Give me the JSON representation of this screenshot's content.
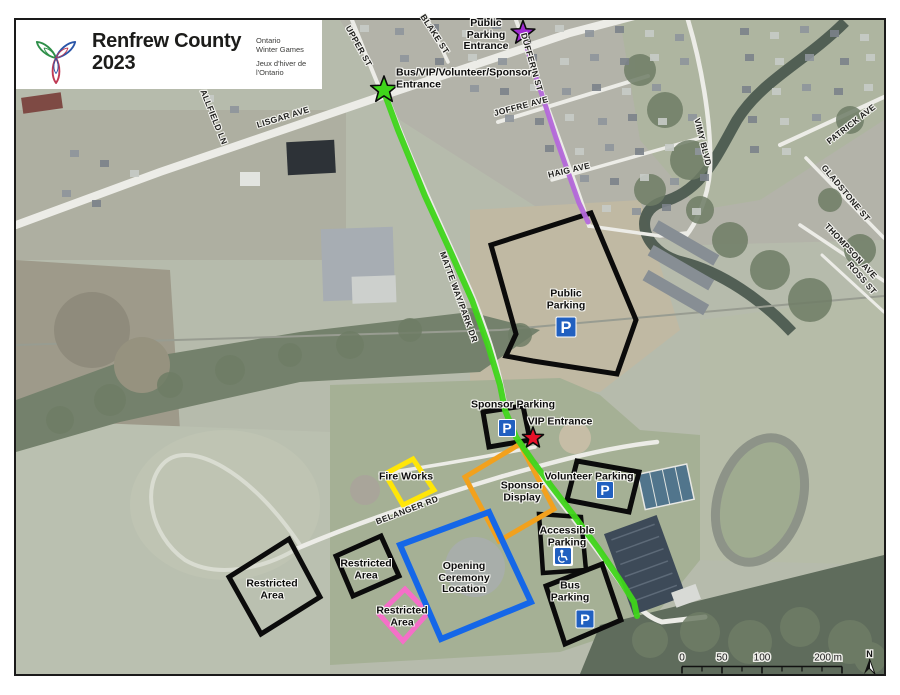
{
  "logo": {
    "title_line1": "Renfrew County",
    "title_line2": "2023",
    "org_en_line1": "Ontario",
    "org_en_line2": "Winter Games",
    "org_fr_line1": "Jeux d'hiver de",
    "org_fr_line2": "l'Ontario"
  },
  "map": {
    "street_labels": [
      {
        "name": "street-label-lisgar-ave",
        "text": "LISGAR AVE",
        "x": 283,
        "y": 117,
        "rot": -17
      },
      {
        "name": "street-label-allfield-ln",
        "text": "ALLFIELD LN",
        "x": 214,
        "y": 117,
        "rot": 68
      },
      {
        "name": "street-label-upper-st",
        "text": "UPPER ST",
        "x": 359,
        "y": 46,
        "rot": 61
      },
      {
        "name": "street-label-blake-st",
        "text": "BLAKE ST",
        "x": 435,
        "y": 34,
        "rot": 57
      },
      {
        "name": "street-label-dufferin-st",
        "text": "DUFFERIN ST",
        "x": 532,
        "y": 62,
        "rot": 74
      },
      {
        "name": "street-label-joffre-ave",
        "text": "JOFFRE AVE",
        "x": 521,
        "y": 106,
        "rot": -15
      },
      {
        "name": "street-label-haig-ave",
        "text": "HAIG AVE",
        "x": 569,
        "y": 170,
        "rot": -13
      },
      {
        "name": "street-label-vimy-blvd",
        "text": "VIMY BLVD",
        "x": 703,
        "y": 142,
        "rot": 76
      },
      {
        "name": "street-label-patrick-ave",
        "text": "PATRICK AVE",
        "x": 851,
        "y": 124,
        "rot": -38
      },
      {
        "name": "street-label-gladstone-st",
        "text": "GLADSTONE ST",
        "x": 846,
        "y": 193,
        "rot": 50
      },
      {
        "name": "street-label-thompson-ave",
        "text": "THOMPSON AVE",
        "x": 851,
        "y": 251,
        "rot": 47
      },
      {
        "name": "street-label-ross-st",
        "text": "ROSS ST",
        "x": 862,
        "y": 278,
        "rot": 49
      },
      {
        "name": "street-label-matte-way-park-dr",
        "text": "MATTE WAY/PARK DR",
        "x": 459,
        "y": 297,
        "rot": 70
      },
      {
        "name": "street-label-belanger-rd",
        "text": "BELANGER RD",
        "x": 407,
        "y": 510,
        "rot": -21
      }
    ],
    "annotations": [
      {
        "name": "public-parking-entrance-label",
        "lines": [
          "Public",
          "Parking",
          "Entrance"
        ],
        "x": 486,
        "y": 35
      },
      {
        "name": "bus-vip-volunteer-sponsor-entrance-label",
        "lines": [
          "Bus/VIP/Volunteer/Sponsor",
          "Entrance"
        ],
        "x": 396,
        "y": 79,
        "align": "left"
      },
      {
        "name": "public-parking-label",
        "lines": [
          "Public",
          "Parking"
        ],
        "x": 566,
        "y": 300
      },
      {
        "name": "sponsor-parking-label",
        "lines": [
          "Sponsor Parking"
        ],
        "x": 513,
        "y": 405
      },
      {
        "name": "vip-entrance-label",
        "lines": [
          "VIP Entrance"
        ],
        "x": 560,
        "y": 422
      },
      {
        "name": "volunteer-parking-label",
        "lines": [
          "Volunteer Parking"
        ],
        "x": 589,
        "y": 477
      },
      {
        "name": "sponsor-display-label",
        "lines": [
          "Sponsor",
          "Display"
        ],
        "x": 522,
        "y": 492
      },
      {
        "name": "accessible-parking-label",
        "lines": [
          "Accessible",
          "Parking"
        ],
        "x": 567,
        "y": 537
      },
      {
        "name": "bus-parking-label",
        "lines": [
          "Bus",
          "Parking"
        ],
        "x": 570,
        "y": 592
      },
      {
        "name": "opening-ceremony-location-label",
        "lines": [
          "Opening",
          "Ceremony",
          "Location"
        ],
        "x": 464,
        "y": 578
      },
      {
        "name": "fire-works-label",
        "lines": [
          "Fire Works"
        ],
        "x": 406,
        "y": 477
      },
      {
        "name": "restricted-area-west-label",
        "lines": [
          "Restricted",
          "Area"
        ],
        "x": 272,
        "y": 590
      },
      {
        "name": "restricted-area-mid-label",
        "lines": [
          "Restricted",
          "Area"
        ],
        "x": 366,
        "y": 570
      },
      {
        "name": "restricted-area-south-label",
        "lines": [
          "Restricted",
          "Area"
        ],
        "x": 402,
        "y": 617
      }
    ],
    "zones": [
      {
        "name": "public-parking-zone",
        "color": "#0b0b0b",
        "width": 5,
        "points": "491,245 591,213 636,320 617,374 533,361 506,356 516,334"
      },
      {
        "name": "sponsor-parking-zone",
        "color": "#0b0b0b",
        "width": 5,
        "points": "483,412 523,406 530,440 489,447"
      },
      {
        "name": "volunteer-parking-zone",
        "color": "#0b0b0b",
        "width": 5,
        "points": "577,461 639,472 629,512 567,500"
      },
      {
        "name": "accessible-parking-zone",
        "color": "#0b0b0b",
        "width": 4.5,
        "points": "539,514 581,517 586,570 543,573"
      },
      {
        "name": "bus-parking-zone",
        "color": "#0b0b0b",
        "width": 5,
        "points": "546,586 602,564 621,620 565,644"
      },
      {
        "name": "restricted-area-west-zone",
        "color": "#0b0b0b",
        "width": 5,
        "points": "289,539 320,597 261,634 229,577"
      },
      {
        "name": "restricted-area-mid-zone",
        "color": "#0b0b0b",
        "width": 5,
        "points": "381,536 399,576 353,596 336,556"
      },
      {
        "name": "restricted-area-south-zone",
        "color": "#f56fc8",
        "width": 5,
        "points": "405,589 428,613 403,641 379,614"
      },
      {
        "name": "fire-works-zone",
        "color": "#ffe607",
        "width": 5,
        "points": "413,459 434,490 403,505 385,474"
      },
      {
        "name": "sponsor-display-zone",
        "color": "#f2a11d",
        "width": 5,
        "points": "520,444 465,477 499,541 554,509"
      },
      {
        "name": "opening-ceremony-zone",
        "color": "#1567e8",
        "width": 6,
        "points": "400,545 489,512 531,602 441,639"
      }
    ],
    "routes": [
      {
        "name": "bus-vip-route-line",
        "color": "#3fd51a",
        "width": 6,
        "points": "384,92 398,130 425,196 452,255 472,300 488,345 500,385 505,410 516,437 532,460 552,487 575,517 598,548 620,580 634,602 637,616"
      },
      {
        "name": "public-parking-route-line",
        "color": "#b468da",
        "width": 5,
        "points": "525,40 533,68 543,98 556,138 568,172 579,203 588,222"
      }
    ],
    "stars": [
      {
        "name": "bus-vip-entrance-star",
        "x": 384,
        "y": 90,
        "size": 14,
        "color": "#3fd51a"
      },
      {
        "name": "public-parking-entrance-star",
        "x": 523,
        "y": 33,
        "size": 12.5,
        "color": "#a02ad2"
      },
      {
        "name": "vip-entrance-star",
        "x": 533,
        "y": 438,
        "size": 11,
        "color": "#e81129"
      }
    ],
    "parking_icons": [
      {
        "name": "public-parking-icon",
        "x": 566,
        "y": 327,
        "size": 20
      },
      {
        "name": "sponsor-parking-icon",
        "x": 507,
        "y": 428,
        "size": 17
      },
      {
        "name": "volunteer-parking-icon",
        "x": 605,
        "y": 490,
        "size": 17
      },
      {
        "name": "bus-parking-icon",
        "x": 585,
        "y": 619,
        "size": 18
      }
    ],
    "accessible_icon": {
      "name": "accessible-parking-icon",
      "x": 563,
      "y": 556,
      "size": 16
    },
    "parking_letter": "P",
    "scalebar": {
      "x": 682,
      "y": 666.5,
      "length": 160,
      "intervals": 8,
      "labels": [
        {
          "text": "0",
          "dx": 0
        },
        {
          "text": "50",
          "dx": 40
        },
        {
          "text": "100",
          "dx": 80
        },
        {
          "text": "200 m",
          "dx": 160
        }
      ]
    },
    "north_arrow": {
      "label": "N",
      "x": 869.5,
      "y": 657
    }
  }
}
